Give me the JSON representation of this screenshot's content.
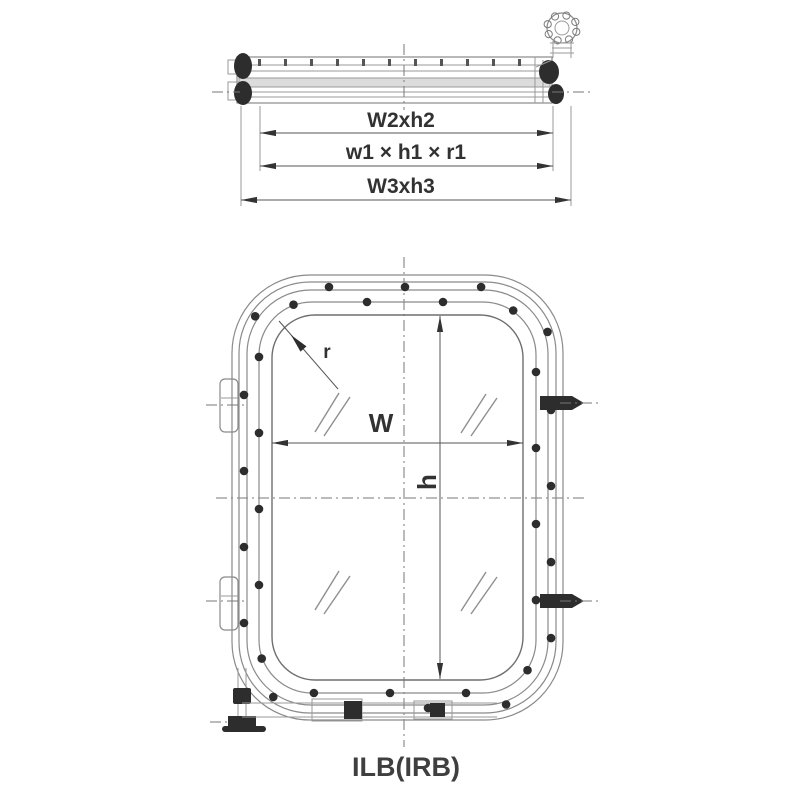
{
  "figure": {
    "caption": "ILB(IRB)",
    "section_view": {
      "dims": [
        {
          "id": "glass-size",
          "label": "W2xh2"
        },
        {
          "id": "clear-size",
          "label": "w1 × h1 × r1"
        },
        {
          "id": "overall-size",
          "label": "W3xh3"
        }
      ]
    },
    "front_view": {
      "corner_radius_label": "r",
      "width_label": "W",
      "height_label": "h"
    },
    "colors": {
      "line": "#8a8a8a",
      "dark": "#2d2d2d",
      "text": "#323232",
      "background": "#ffffff"
    }
  }
}
